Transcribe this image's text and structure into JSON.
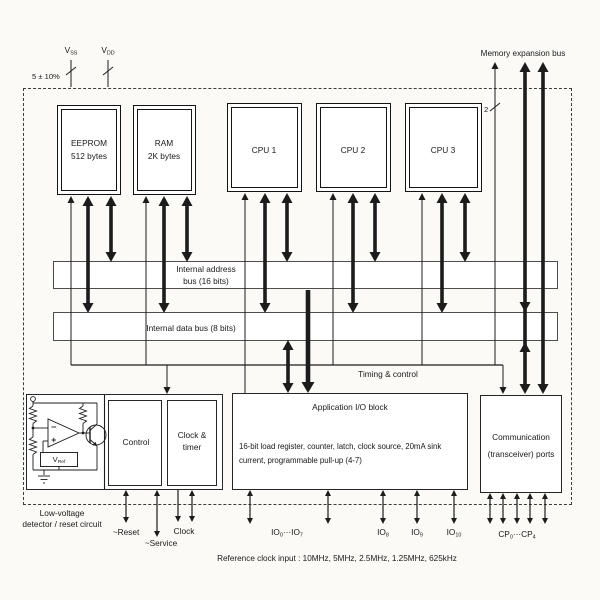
{
  "colors": {
    "ink": "#191919",
    "background": "#fbfaf7"
  },
  "pins": {
    "vss_base": "V",
    "vss_sub": "SS",
    "vdd_base": "V",
    "vdd_sub": "DD",
    "tolerance": "5 ± 10%"
  },
  "mem_bus": {
    "label": "Memory expansion bus",
    "width_marker": "2"
  },
  "blocks": {
    "eeprom_l1": "EEPROM",
    "eeprom_l2": "512 bytes",
    "ram_l1": "RAM",
    "ram_l2": "2K bytes",
    "cpu1": "CPU 1",
    "cpu2": "CPU 2",
    "cpu3": "CPU 3",
    "abus_l1": "Internal address",
    "abus_l2": "bus (16 bits)",
    "dbus": "Internal data bus (8 bits)",
    "timing": "Timing & control",
    "control": "Control",
    "clock_l1": "Clock &",
    "clock_l2": "timer",
    "app_title": "Application I/O block",
    "app_d1": "16-bit load register, counter, latch, clock source, 20mA sink",
    "app_d2": "current, programmable pull-up (4-7)",
    "comm_l1": "Communication",
    "comm_l2": "(transceiver) ports",
    "lvd_l1": "Low-voltage",
    "lvd_l2": "detector / reset circuit",
    "vref_base": "V",
    "vref_sub": "Ref"
  },
  "signals": {
    "reset": "~Reset",
    "service": "~Service",
    "clock": "Clock",
    "io07_b1": "IO",
    "io07_s1": "0",
    "io07_dots": "···",
    "io07_b2": "IO",
    "io07_s2": "7",
    "io8_b": "IO",
    "io8_s": "8",
    "io9_b": "IO",
    "io9_s": "9",
    "io10_b": "IO",
    "io10_s": "10",
    "cp_b1": "CP",
    "cp_s1": "0",
    "cp_dots": "···",
    "cp_b2": "CP",
    "cp_s2": "4"
  },
  "caption": "Reference clock input : 10MHz, 5MHz, 2.5MHz, 1.25MHz, 625kHz"
}
